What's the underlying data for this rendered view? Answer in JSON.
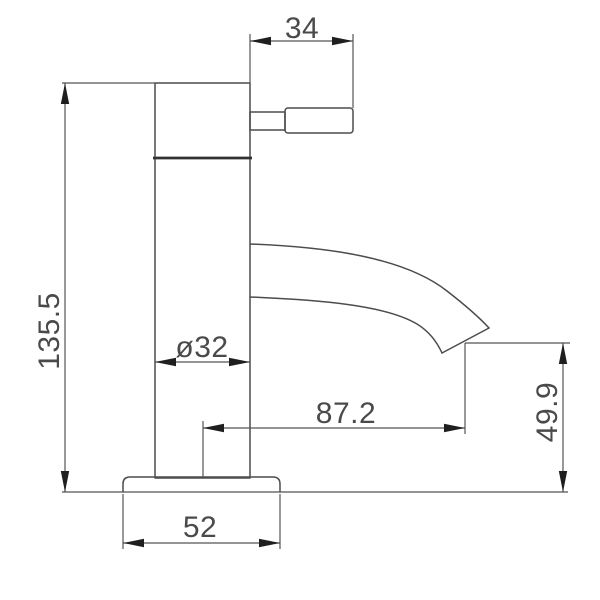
{
  "drawing": {
    "background_color": "#ffffff",
    "line_color": "#4c4c4c",
    "text_color": "#4a4a4a",
    "arrow_color": "#1f1f1f",
    "dimensions": {
      "handle_length": "34",
      "overall_height": "135.5",
      "body_diameter": "ø32",
      "spout_reach": "87.2",
      "spout_outlet_height": "49.9",
      "base_width": "52"
    }
  }
}
